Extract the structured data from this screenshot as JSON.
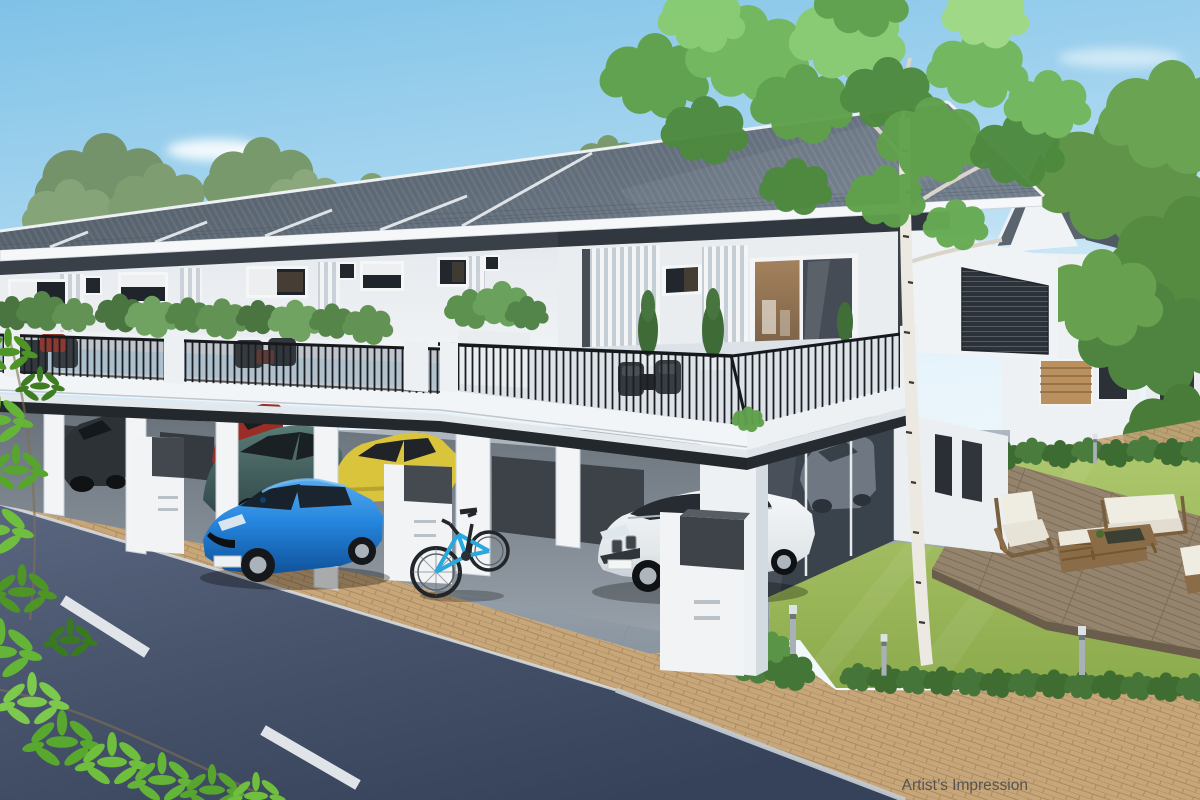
{
  "meta": {
    "type": "architectural-rendering",
    "description": "Artist's impression of a modern double-storey terrace home development with carports, balconies, garden deck and street"
  },
  "caption": {
    "text": "Artist’s Impression"
  },
  "palette": {
    "sky_top": "#82c4e8",
    "sky_horizon": "#eef6fc",
    "roof": "#5c6773",
    "fascia_white": "#f5f7f8",
    "wall_white": "#eceff2",
    "accent_dark": "#3a4047",
    "railing_black": "#1a1e22",
    "road_asphalt": "#46526a",
    "road_marking": "#e9edf0",
    "paver_tan": "#c7a67a",
    "concrete": "#9aa4ae",
    "grass_green": "#9bb95c",
    "foliage_green": "#5fa148",
    "deck_wood": "#95846d",
    "furniture_wood": "#8a6c46",
    "cushion_white": "#efece2",
    "car_blue": "#1e7bce",
    "car_teal": "#44605c",
    "car_yellow": "#d9c43c",
    "car_red": "#9a2e27",
    "car_dark_grey": "#2d3237",
    "car_white": "#f2f4f6",
    "bike_blue": "#2aa7dc",
    "birch_bark": "#ece9e2",
    "caption_grey": "#43484d"
  },
  "scene": {
    "buildings": [
      {
        "name": "terrace-row",
        "label": "Double-storey terrace house row with slate roof, balconies and carports"
      },
      {
        "name": "corner-unit",
        "label": "Corner terrace unit with wrap-around balcony terrace"
      },
      {
        "name": "semi-d-house",
        "label": "Neighbouring double-storey house behind corner unit"
      },
      {
        "name": "far-right-house",
        "label": "House partially hidden by trees at right edge"
      }
    ],
    "vehicles": [
      {
        "name": "blue-sedan",
        "color": "blue",
        "location": "driveway"
      },
      {
        "name": "white-suv",
        "color": "white",
        "location": "corner carport"
      },
      {
        "name": "teal-hatchback",
        "color": "dark teal",
        "location": "carport bay"
      },
      {
        "name": "yellow-hatchback",
        "color": "yellow",
        "location": "carport bay"
      },
      {
        "name": "red-car",
        "color": "red",
        "location": "carport bay"
      },
      {
        "name": "dark-grey-car",
        "color": "dark grey",
        "location": "far left carport bay"
      },
      {
        "name": "grey-car-garage",
        "color": "grey",
        "location": "behind glass garage door"
      }
    ],
    "objects": [
      {
        "name": "bicycle",
        "color": "blue"
      },
      {
        "name": "mailbox-pedestal",
        "count": 3
      },
      {
        "name": "garden-bollard-light",
        "count": 4
      },
      {
        "name": "outdoor-sofa-set",
        "material": "wood with white cushions"
      },
      {
        "name": "timber-deck"
      },
      {
        "name": "birch-tree"
      },
      {
        "name": "hedges"
      },
      {
        "name": "balcony-planters"
      },
      {
        "name": "road-dashed-line",
        "count": 2
      }
    ]
  }
}
